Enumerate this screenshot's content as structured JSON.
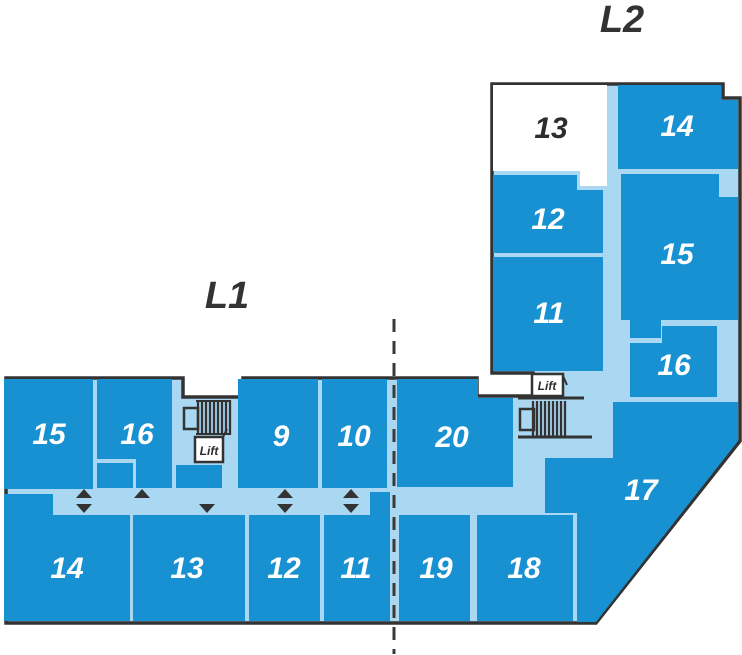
{
  "colors": {
    "unit_fill": "#1791d1",
    "floor_fill": "#aad8f2",
    "outline": "#333333",
    "unit_label": "#ffffff",
    "highlight_unit_fill": "#ffffff",
    "highlight_unit_label": "#2d2d2d",
    "divider": "#3a3a3a"
  },
  "levels": {
    "l1": {
      "title": "L1",
      "lift_label": "Lift",
      "units": [
        {
          "label": "15"
        },
        {
          "label": "16"
        },
        {
          "label": "9"
        },
        {
          "label": "10"
        },
        {
          "label": "20"
        },
        {
          "label": "14"
        },
        {
          "label": "13"
        },
        {
          "label": "12"
        },
        {
          "label": "11"
        },
        {
          "label": "19"
        },
        {
          "label": "18"
        }
      ]
    },
    "l2": {
      "title": "L2",
      "lift_label": "Lift",
      "units": [
        {
          "label": "13",
          "highlighted": true
        },
        {
          "label": "14"
        },
        {
          "label": "12"
        },
        {
          "label": "15"
        },
        {
          "label": "11"
        },
        {
          "label": "16"
        },
        {
          "label": "17"
        }
      ]
    }
  }
}
